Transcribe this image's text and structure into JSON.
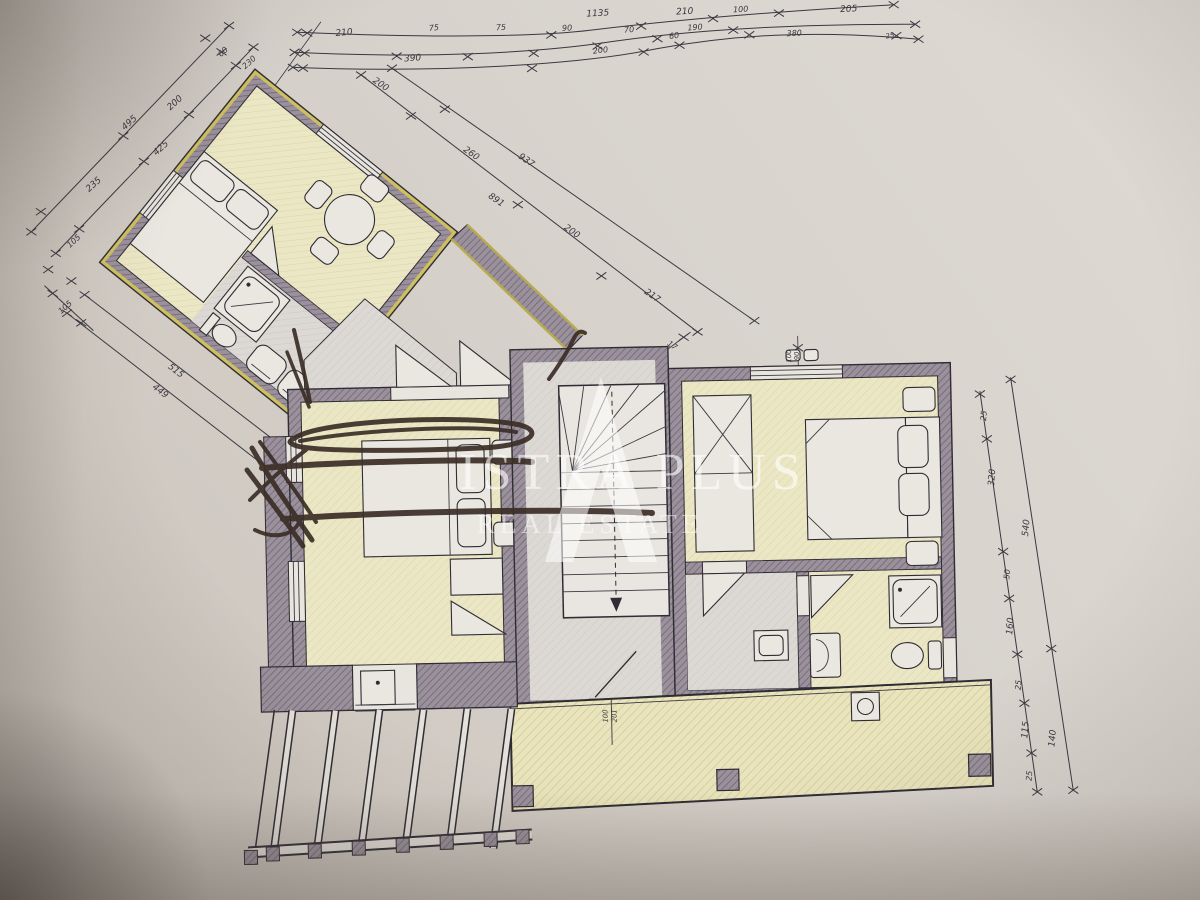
{
  "document": {
    "kind": "floor-plan-photo"
  },
  "watermark": {
    "brand": "ISTRA PLUS",
    "tagline": "REAL ESTATE"
  },
  "colors": {
    "paper": "#d7d2cc",
    "ink": "#34323a",
    "wall": "#9a919c",
    "room": "#ebe6c4",
    "terrace": "#e9e4bb",
    "wing_wall": "#cec060",
    "watermark": "#ffffff",
    "pen": "#3b2e27"
  },
  "dims": {
    "top1": [
      "1135",
      "210",
      "100",
      "205"
    ],
    "top2": [
      "210",
      "75",
      "75",
      "90",
      "70",
      "190"
    ],
    "top3": [
      "390",
      "200",
      "60",
      "380",
      "25"
    ],
    "wing": [
      "60",
      "230",
      "200",
      "495",
      "425",
      "235",
      "105",
      "105",
      "515",
      "449"
    ],
    "diag": [
      "200",
      "937",
      "260",
      "891",
      "200",
      "217"
    ],
    "right_inner": [
      "25",
      "320",
      "50",
      "160",
      "25",
      "115",
      "25"
    ],
    "right_outer": [
      "540",
      "140"
    ],
    "bath": [
      "50",
      "80",
      "80"
    ],
    "door": [
      "100",
      "201"
    ],
    "window": [
      "100",
      "90"
    ],
    "note": "17"
  }
}
